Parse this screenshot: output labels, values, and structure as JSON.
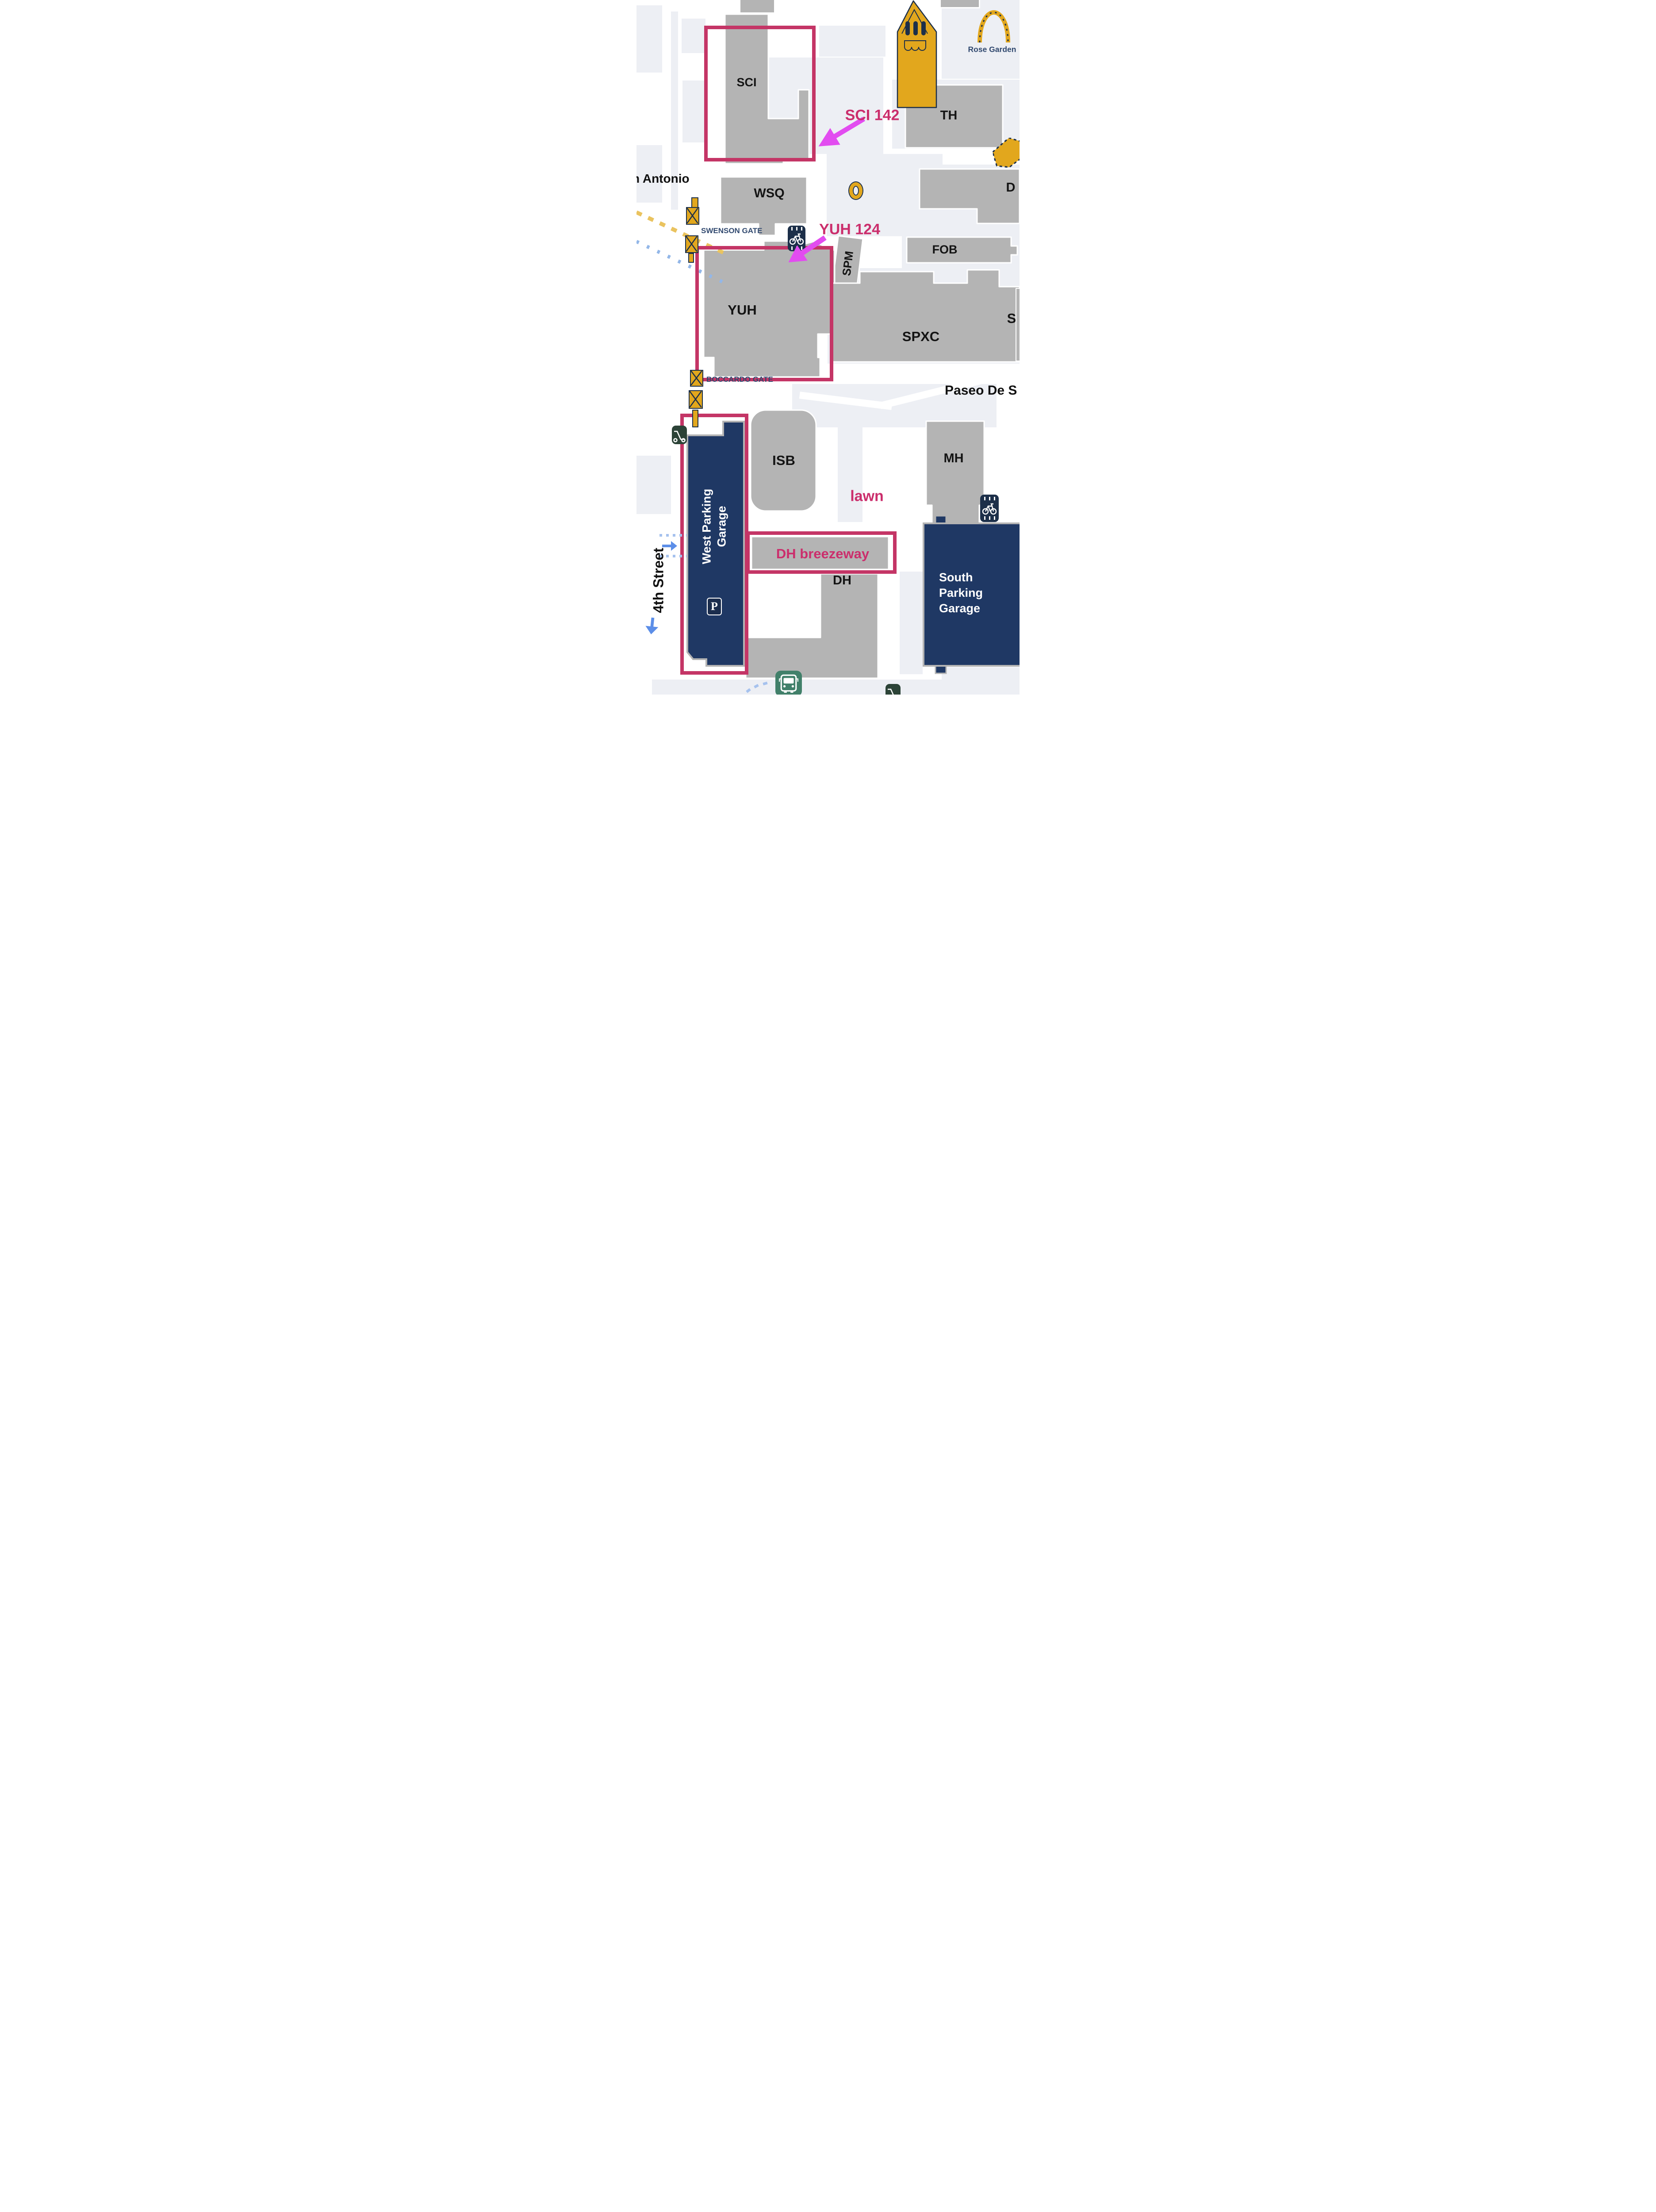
{
  "colors": {
    "building_gray": "#b4b4b4",
    "block_panel": "#edeff4",
    "garage_navy": "#1f3864",
    "highlight_pink": "#c43566",
    "annotation_pink": "#cb2e6c",
    "arrow_magenta": "#e24cf0",
    "gate_gold": "#e2a71d",
    "outline_navy": "#1c2f49",
    "label_navy": "#31496f",
    "bus_green": "#41806a",
    "scooter_green": "#2c4337",
    "arrow_blue": "#5c8ee8",
    "dash_yellow": "#eac35f",
    "dot_blue": "#a6c2ee"
  },
  "buildings": {
    "sci": "SCI",
    "wsq": "WSQ",
    "th": "TH",
    "d": "D",
    "fob": "FOB",
    "spm": "SPM",
    "yuh": "YUH",
    "spxc": "SPXC",
    "s_partial": "S",
    "isb": "ISB",
    "mh": "MH",
    "dh": "DH"
  },
  "garages": {
    "west": "West Parking Garage",
    "south": "South Parking Garage",
    "parking_symbol": "P"
  },
  "annotations": {
    "sci142": "SCI 142",
    "yuh124": "YUH 124",
    "lawn": "lawn",
    "dh_breezeway": "DH breezeway"
  },
  "gates": {
    "swenson": "SWENSON GATE",
    "boccardo": "BOCCARDO GATE"
  },
  "streets": {
    "san_antonio": "n Antonio",
    "fourth": "4th Street",
    "paseo": "Paseo De S"
  },
  "poi": {
    "rose_garden": "Rose Garden"
  },
  "icons": [
    "bike-lane-icon",
    "scooter-icon",
    "bus-icon",
    "parking-icon",
    "gate-icon",
    "fountain-icon",
    "bell-tower-icon",
    "rose-arch-icon",
    "blue-right-arrow",
    "blue-down-arrow",
    "magenta-pointer-arrow"
  ]
}
